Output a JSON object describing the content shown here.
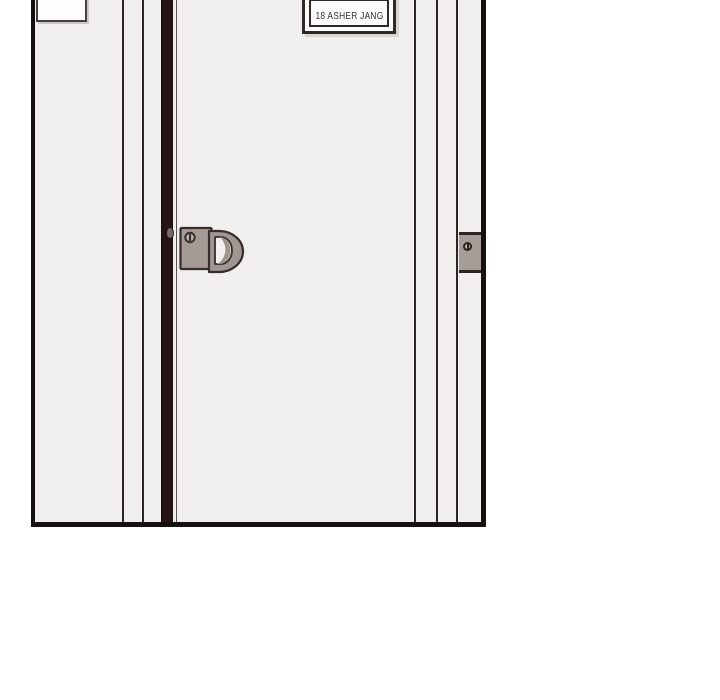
{
  "scene": {
    "type": "comic-panel-door",
    "nameplate": {
      "text": "18 ASHER JANG"
    },
    "empty_plate": {
      "text": ""
    }
  },
  "icons": {
    "door_handle": "d-shaped-pull-handle",
    "hinge_screw": "slotted-screw",
    "handle_screw": "slotted-screw",
    "latch": "latch-bolt"
  },
  "colors": {
    "background": "#ffffff",
    "wall": "#f0efee",
    "panel_border": "#16100e",
    "frame_line": "#2d2523",
    "door_gap": "#251413",
    "door_edge": "#5a534f",
    "handle_plate": "#a49b97",
    "handle_ring": "#a09793",
    "handle_inner": "#f2f0ef",
    "handle_shadow": "#9e9591",
    "hinge_plate": "#a69d99",
    "plate_fill": "#fbfafa",
    "plate_border": "#2f2825",
    "plate_text": "#3a3330",
    "plate_shadow": "#d9d5d3"
  }
}
